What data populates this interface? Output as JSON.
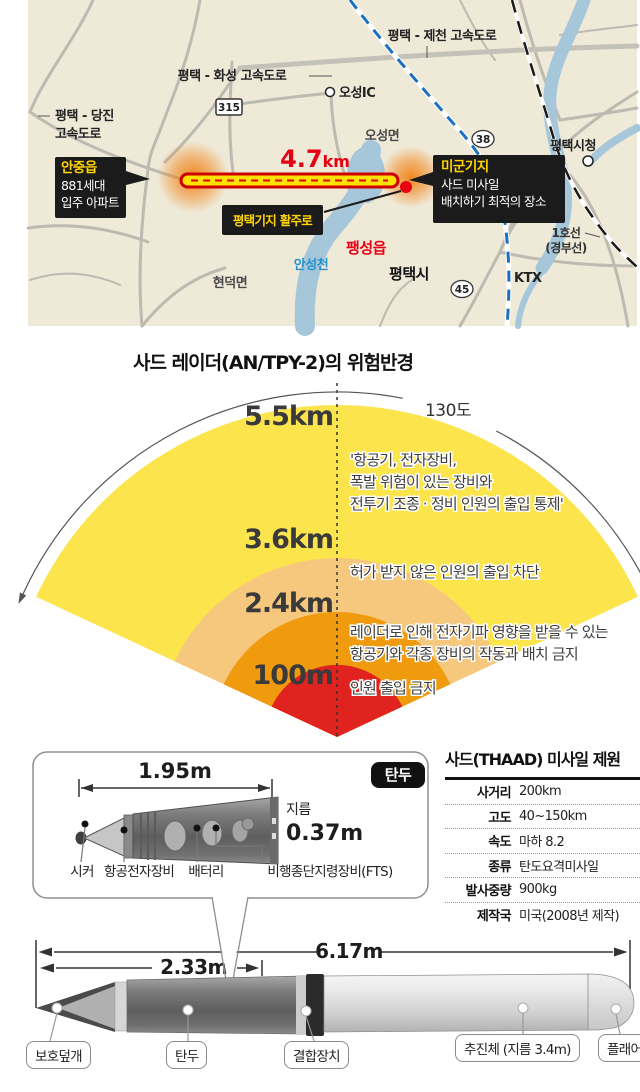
{
  "map": {
    "highway_jecheon": "평택 - 제천 고속도로",
    "highway_hwaseong": "평택 - 화성 고속도로",
    "highway_dangjin": [
      "평택 - 당진",
      "고속도로"
    ],
    "route_badges": {
      "r315": "315",
      "r38": "38",
      "r45": "45"
    },
    "oseong_ic": "오성IC",
    "oseong_myeon": "오성면",
    "pyeongtaek_city_hall": "평택시청",
    "line1": "1호선",
    "line1_sub": "(경부선)",
    "ktx": "KTX",
    "hyeondeok_myeon": "현덕면",
    "pyeongtaek_si": "평택시",
    "paengseong_eup": "팽성읍",
    "anseongcheon": "안성천",
    "distance_value": "4.7",
    "distance_unit": "km",
    "anjung_box": {
      "title": "안중읍",
      "lines": [
        "881세대",
        "입주 아파트"
      ]
    },
    "usbase_box": {
      "title": "미군기지",
      "lines": [
        "사드 미사일",
        "배치하기 최적의 장소"
      ]
    },
    "runway_box": "평택기지 활주로",
    "colors": {
      "accent_red": "#e60012",
      "label_yellow": "#ffd400",
      "river_blue": "#a6c6d9"
    }
  },
  "radar": {
    "title": "사드 레이더(AN/TPY-2)의 위험반경",
    "angle_label": "130도",
    "rings": [
      {
        "label": "5.5km",
        "color": "#fce44c",
        "lines": [
          "'항공기, 전자장비,",
          "폭발 위험이 있는 장비와",
          "전투기 조종 · 정비 인원의 출입 통제'"
        ]
      },
      {
        "label": "3.6km",
        "color": "#f6c87d",
        "lines": [
          "허가 받지 않은 인원의 출입 차단"
        ]
      },
      {
        "label": "2.4km",
        "color": "#f09a0e",
        "lines": [
          "레이더로 인해 전자기파 영향을 받을 수 있는",
          "항공기와 각종 장비의 작동과 배치 금지"
        ]
      },
      {
        "label": "100m",
        "color": "#e0231f",
        "lines": [
          "인원 출입 금지"
        ]
      }
    ]
  },
  "warhead_panel": {
    "length": "1.95m",
    "badge": "탄두",
    "diameter_label": "지름",
    "diameter_value": "0.37m",
    "parts": [
      "시커",
      "항공전자장비",
      "배터리",
      "비행종단지령장비(FTS)"
    ]
  },
  "spec_table": {
    "title": "사드(THAAD) 미사일 제원",
    "rows": [
      {
        "label": "사거리",
        "value": "200km"
      },
      {
        "label": "고도",
        "value": "40~150km"
      },
      {
        "label": "속도",
        "value": "마하 8.2"
      },
      {
        "label": "종류",
        "value": "탄도요격미사일"
      },
      {
        "label": "발사중량",
        "value": "900kg"
      },
      {
        "label": "제작국",
        "value": "미국(2008년 제작)"
      }
    ]
  },
  "missile_diagram": {
    "total_length": "6.17m",
    "front_length": "2.33m",
    "part_labels": [
      "보호덮개",
      "탄두",
      "결합장치",
      "추진체 (지름 3.4m)",
      "플래어"
    ]
  }
}
